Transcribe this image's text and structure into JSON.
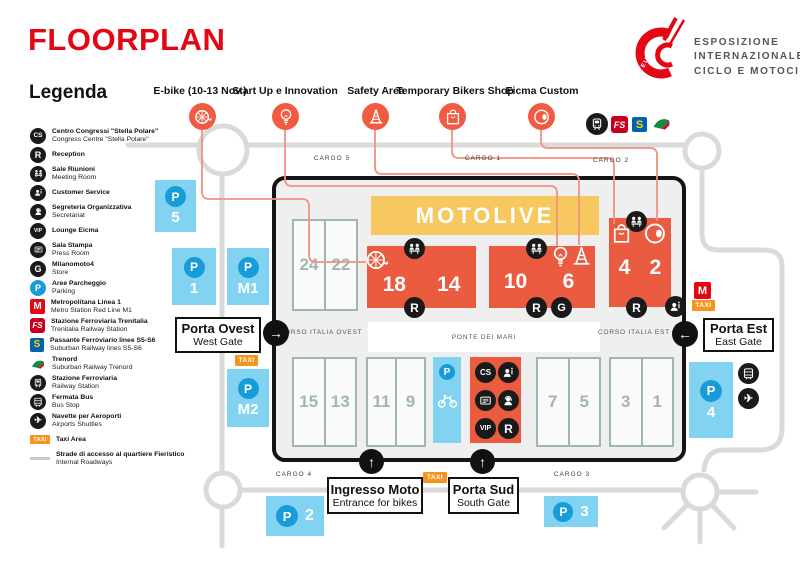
{
  "title": "FLOORPLAN",
  "logo": {
    "mark_text": "EICMA",
    "line1": "ESPOSIZIONE",
    "line2": "INTERNAZIONALE",
    "line3": "CICLO E MOTOCICLO"
  },
  "legend": {
    "heading": "Legenda",
    "items": [
      {
        "icon": "congress-centre-icon",
        "it": "Centro Congressi \"Stella Polare\"",
        "en": "Congress Centre \"Stella Polare\""
      },
      {
        "icon": "reception-icon",
        "it": "Reception",
        "en": ""
      },
      {
        "icon": "meeting-room-icon",
        "it": "Sale Riunioni",
        "en": "Meeting Room"
      },
      {
        "icon": "customer-service-icon",
        "it": "Customer Service",
        "en": ""
      },
      {
        "icon": "secretariat-icon",
        "it": "Segreteria Organizzativa",
        "en": "Secretariat"
      },
      {
        "icon": "vip-lounge-icon",
        "it": "Lounge Eicma",
        "en": ""
      },
      {
        "icon": "press-room-icon",
        "it": "Sala Stampa",
        "en": "Press Room"
      },
      {
        "icon": "store-icon",
        "it": "Milanomoto4",
        "en": "Store"
      },
      {
        "icon": "parking-icon",
        "it": "Aree Parcheggio",
        "en": "Parking"
      },
      {
        "icon": "metro-icon",
        "it": "Metropolitana Linea 1",
        "en": "Metro Station Red Line M1"
      },
      {
        "icon": "trenitalia-icon",
        "it": "Stazione Ferroviaria Trenitalia",
        "en": "Trenitalia Railway Station"
      },
      {
        "icon": "suburban-railway-icon",
        "it": "Passante Ferroviario linee S5-S6",
        "en": "Suburban Railway lines S5-S6"
      },
      {
        "icon": "trenord-icon",
        "it": "Trenord",
        "en": "Suburban Railway Trenord"
      },
      {
        "icon": "railway-station-icon",
        "it": "Stazione Ferroviaria",
        "en": "Railway Station"
      },
      {
        "icon": "bus-stop-icon",
        "it": "Fermata Bus",
        "en": "Bus Stop"
      },
      {
        "icon": "airport-shuttle-icon",
        "it": "Navette per Aeroporti",
        "en": "Airports Shuttles"
      },
      {
        "icon": "taxi-area-icon",
        "it": "Taxi Area",
        "en": ""
      },
      {
        "icon": "internal-roadway-icon",
        "it": "Strade di accesso al quartiere Fieristico",
        "en": "Internal Roadways"
      }
    ]
  },
  "features": [
    {
      "label": "E-bike (10-13 Nov.)"
    },
    {
      "label": "Start Up e Innovation"
    },
    {
      "label": "Safety Area"
    },
    {
      "label": "Temporary Bikers Shop"
    },
    {
      "label": "Eicma Custom"
    }
  ],
  "map": {
    "motolive": "MOTOLIVE",
    "cargo": {
      "c5": "CARGO 5",
      "c1": "CARGO 1",
      "c2": "CARGO 2",
      "c4": "CARGO 4",
      "c3": "CARGO 3"
    },
    "streets": {
      "west": "CORSO ITALIA OVEST",
      "bridge": "PONTE DEI MARI",
      "east": "CORSO ITALIA EST"
    },
    "gates": {
      "west": {
        "it": "Porta Ovest",
        "en": "West Gate"
      },
      "east": {
        "it": "Porta Est",
        "en": "East Gate"
      },
      "south": {
        "it": "Porta Sud",
        "en": "South Gate"
      },
      "moto": {
        "it": "Ingresso Moto",
        "en": "Entrance for bikes"
      }
    },
    "halls": {
      "h24": "24",
      "h22": "22",
      "h18": "18",
      "h14": "14",
      "h10": "10",
      "h6": "6",
      "h4": "4",
      "h2": "2",
      "h15": "15",
      "h13": "13",
      "h11": "11",
      "h9": "9",
      "h7": "7",
      "h5": "5",
      "h3": "3",
      "h1": "1"
    },
    "parking": {
      "p5": "5",
      "p1": "1",
      "pm1": "M1",
      "pm2": "M2",
      "p4": "4",
      "p2": "2",
      "p3": "3"
    },
    "badges": {
      "p": "P",
      "r": "R",
      "cs": "CS",
      "vip": "VIP",
      "m": "M",
      "taxi": "TAXI",
      "g": "G",
      "fs": "FS",
      "s": "S",
      "plane": "✈"
    },
    "arrows": {
      "right": "→",
      "left": "←",
      "up": "↑"
    }
  },
  "colors": {
    "brand_red": "#E30613",
    "hall_red": "#EB5B40",
    "connector_salmon": "#F2917E",
    "motolive_yellow": "#F6C85F",
    "parking_blue": "#82D3F2",
    "parking_circle_blue": "#189CD9",
    "taxi_orange": "#F7941E",
    "road_gray": "#DADADA",
    "hall_outline_teal": "#9FB6B1"
  }
}
